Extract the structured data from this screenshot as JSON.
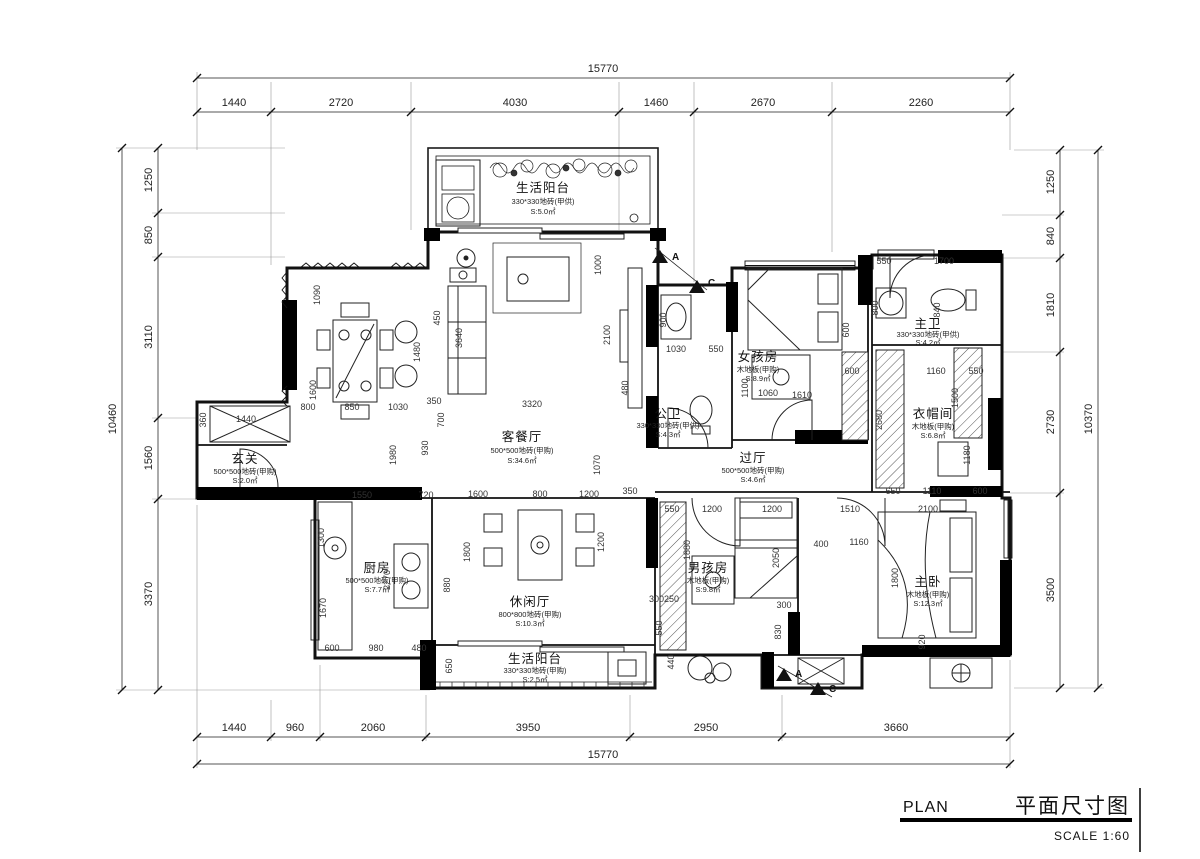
{
  "title_block": {
    "plan_en": "PLAN",
    "plan_cn": "平面尺寸图",
    "scale_label": "SCALE 1:60"
  },
  "colors": {
    "ink": "#111111",
    "dim": "#333333",
    "wall_fill": "#000000"
  },
  "section_markers": [
    "A",
    "C",
    "A",
    "C"
  ],
  "dims": {
    "top": {
      "total": "15770",
      "segments": [
        "1440",
        "2720",
        "4030",
        "1460",
        "2670",
        "2260"
      ]
    },
    "bottom": {
      "total": "15770",
      "segments": [
        "1440",
        "960",
        "2060",
        "3950",
        "2950",
        "3660"
      ]
    },
    "left": {
      "total": "10460",
      "segments": [
        "1250",
        "850",
        "3110",
        "1560",
        "3370"
      ]
    },
    "right": {
      "total": "10370",
      "segments": [
        "1250",
        "840",
        "1810",
        "2730",
        "3500"
      ]
    },
    "interior": [
      "1090",
      "450",
      "3640",
      "1600",
      "1480",
      "930",
      "800",
      "850",
      "1030",
      "350",
      "700",
      "1000",
      "2100",
      "3320",
      "480",
      "900",
      "1030",
      "550",
      "1070",
      "1060",
      "600",
      "1610",
      "1100",
      "550",
      "1700",
      "800",
      "840",
      "1500",
      "2680",
      "1160",
      "550",
      "1180",
      "650",
      "1110",
      "600",
      "1440",
      "360",
      "1980",
      "1550",
      "720",
      "1600",
      "800",
      "1200",
      "350",
      "1300",
      "1670",
      "2270",
      "600",
      "980",
      "480",
      "880",
      "1800",
      "1200",
      "550",
      "1200",
      "1200",
      "1510",
      "1880",
      "2050",
      "400",
      "1160",
      "2100",
      "1800",
      "920",
      "300250",
      "300",
      "830",
      "650",
      "550",
      "440",
      "600"
    ]
  },
  "rooms": [
    {
      "name": "生活阳台",
      "spec": "330*330地砖(甲供)",
      "area": "S:5.0㎡"
    },
    {
      "name": "客餐厅",
      "spec": "500*500地砖(甲购)",
      "area": "S:34.6㎡"
    },
    {
      "name": "公卫",
      "spec": "330*330地砖(甲供)",
      "area": "S:4.3㎡"
    },
    {
      "name": "女孩房",
      "spec": "木地板(甲购)",
      "area": "S:8.9㎡"
    },
    {
      "name": "主卫",
      "spec": "330*330地砖(甲供)",
      "area": "S:4.2㎡"
    },
    {
      "name": "衣帽间",
      "spec": "木地板(甲购)",
      "area": "S:6.8㎡"
    },
    {
      "name": "过厅",
      "spec": "500*500地砖(甲购)",
      "area": "S:4.6㎡"
    },
    {
      "name": "玄关",
      "spec": "500*500地砖(甲购)",
      "area": "S:2.0㎡"
    },
    {
      "name": "厨房",
      "spec": "500*500地砖(甲购)",
      "area": "S:7.7㎡"
    },
    {
      "name": "休闲厅",
      "spec": "800*800地砖(甲购)",
      "area": "S:10.3㎡"
    },
    {
      "name": "男孩房",
      "spec": "木地板(甲购)",
      "area": "S:9.8㎡"
    },
    {
      "name": "主卧",
      "spec": "木地板(甲购)",
      "area": "S:12.3㎡"
    },
    {
      "name": "生活阳台",
      "spec": "330*330地砖(甲购)",
      "area": "S:2.5㎡"
    }
  ]
}
